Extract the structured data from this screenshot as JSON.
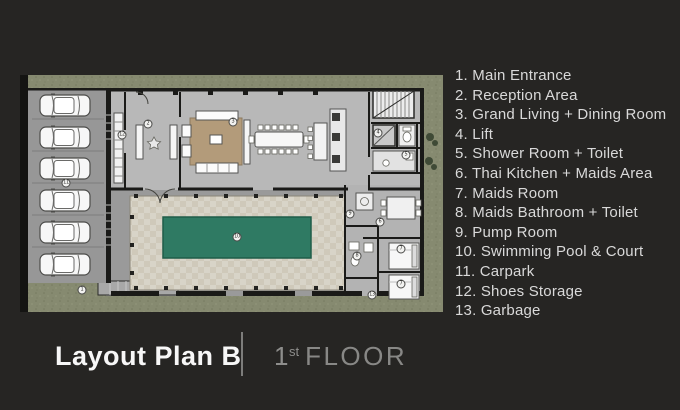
{
  "legend": {
    "items": [
      "1. Main Entrance",
      "2. Reception Area",
      "3. Grand Living + Dining Room",
      "4. Lift",
      "5. Shower Room + Toilet",
      "6. Thai Kitchen + Maids Area",
      "7. Maids Room",
      "8. Maids Bathroom + Toilet",
      "9. Pump Room",
      "10. Swimming Pool & Court",
      "11. Carpark",
      "12. Shoes Storage",
      "13. Garbage"
    ]
  },
  "footer": {
    "plan_title": "Layout Plan B",
    "floor_number": "1",
    "floor_ordinal": "st",
    "floor_word": "FLOOR"
  },
  "plan": {
    "markers": [
      {
        "n": "1",
        "x": 64,
        "y": 215
      },
      {
        "n": "2",
        "x": 130,
        "y": 49
      },
      {
        "n": "3",
        "x": 215,
        "y": 47
      },
      {
        "n": "4",
        "x": 360,
        "y": 58
      },
      {
        "n": "5",
        "x": 388,
        "y": 80
      },
      {
        "n": "6",
        "x": 362,
        "y": 147
      },
      {
        "n": "7",
        "x": 383,
        "y": 174
      },
      {
        "n": "7",
        "x": 383,
        "y": 209
      },
      {
        "n": "8",
        "x": 339,
        "y": 181
      },
      {
        "n": "9",
        "x": 332,
        "y": 139
      },
      {
        "n": "10",
        "x": 219,
        "y": 162
      },
      {
        "n": "11",
        "x": 48,
        "y": 108
      },
      {
        "n": "12",
        "x": 104,
        "y": 60
      },
      {
        "n": "13",
        "x": 354,
        "y": 220
      }
    ],
    "colors": {
      "slide_background": "#262523",
      "legend_text": "#d9d9d9",
      "title_text": "#f7f7f7",
      "floor_text": "#8e8e8c",
      "plan_floor": "#9a9a9a",
      "plan_wing_floor": "#b8b8b8",
      "plan_wall": "#1a1a18",
      "landscape_green": "#868a70",
      "pool_water": "#2f7a63",
      "pool_deck": "#d8d4c8",
      "rug_brown": "#b39b7a",
      "car_body": "#f7f7f7"
    }
  }
}
